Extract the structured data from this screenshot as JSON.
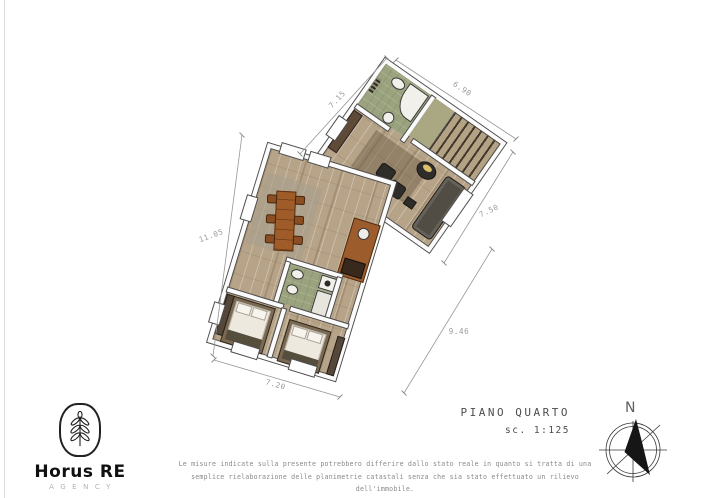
{
  "logo": {
    "brand": "Horus RE",
    "subtitle": "AGENCY"
  },
  "title_block": {
    "floor": "PIANO QUARTO",
    "scale": "sc. 1:125"
  },
  "compass": {
    "north": "N"
  },
  "disclaimer": {
    "line1": "Le misure indicate sulla presente potrebbero differire dallo stato reale in quanto si tratta di una",
    "line2": "semplice rielaborazione delle planimetrie catastali senza che sia stato effettuato un rilievo dell'immobile."
  },
  "plan": {
    "dimensions": [
      {
        "position": "upper-left-edge",
        "label": "7.15"
      },
      {
        "position": "upper-right-edge",
        "label": "6.90"
      },
      {
        "position": "right-edge",
        "label": "7.50"
      },
      {
        "position": "lower-right-diagonal",
        "label": "9.46"
      },
      {
        "position": "left-edge",
        "label": "11.05"
      },
      {
        "position": "bottom-edge",
        "label": "7.20"
      }
    ],
    "colors": {
      "wood_floor": "#b7a488",
      "bath_floor": "#9aa37e",
      "wall_fill": "#fbfbfb",
      "wall_outline": "#4d4d4d",
      "cabinet_orange": "#9d5c2b",
      "sofa_dark": "#514c44",
      "dimension_gray": "#969696"
    }
  }
}
